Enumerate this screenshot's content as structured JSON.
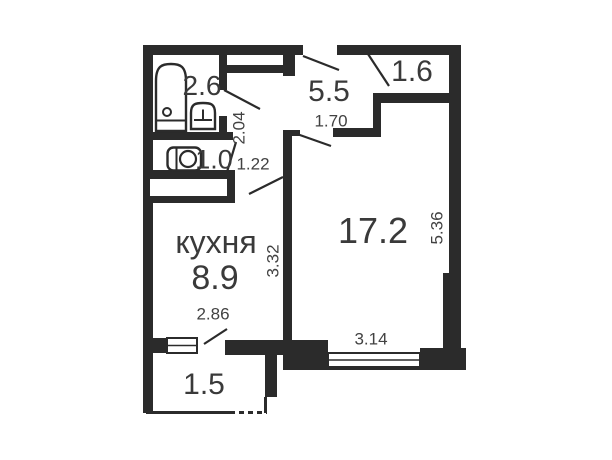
{
  "rooms": {
    "bathroom": {
      "area": "2.6"
    },
    "toilet": {
      "area": "1.0"
    },
    "hallway": {
      "area": "5.5"
    },
    "storage": {
      "area": "1.6"
    },
    "kitchen": {
      "name": "кухня",
      "area": "8.9"
    },
    "living": {
      "area": "17.2"
    },
    "balcony": {
      "area": "1.5"
    }
  },
  "dimensions": {
    "hall_depth": "2.04",
    "toilet_width": "1.22",
    "hallway_width": "1.70",
    "kitchen_depth": "3.32",
    "kitchen_width": "2.86",
    "living_width": "3.14",
    "living_depth": "5.36"
  },
  "icons": [
    "bathtub-icon",
    "sink-icon",
    "toilet-icon",
    "window-icon",
    "door-swing-icon"
  ],
  "colors": {
    "wall": "#2b2b2b",
    "background": "#ffffff",
    "room_text": "#3a3a3a",
    "dimension_text": "#424242"
  }
}
